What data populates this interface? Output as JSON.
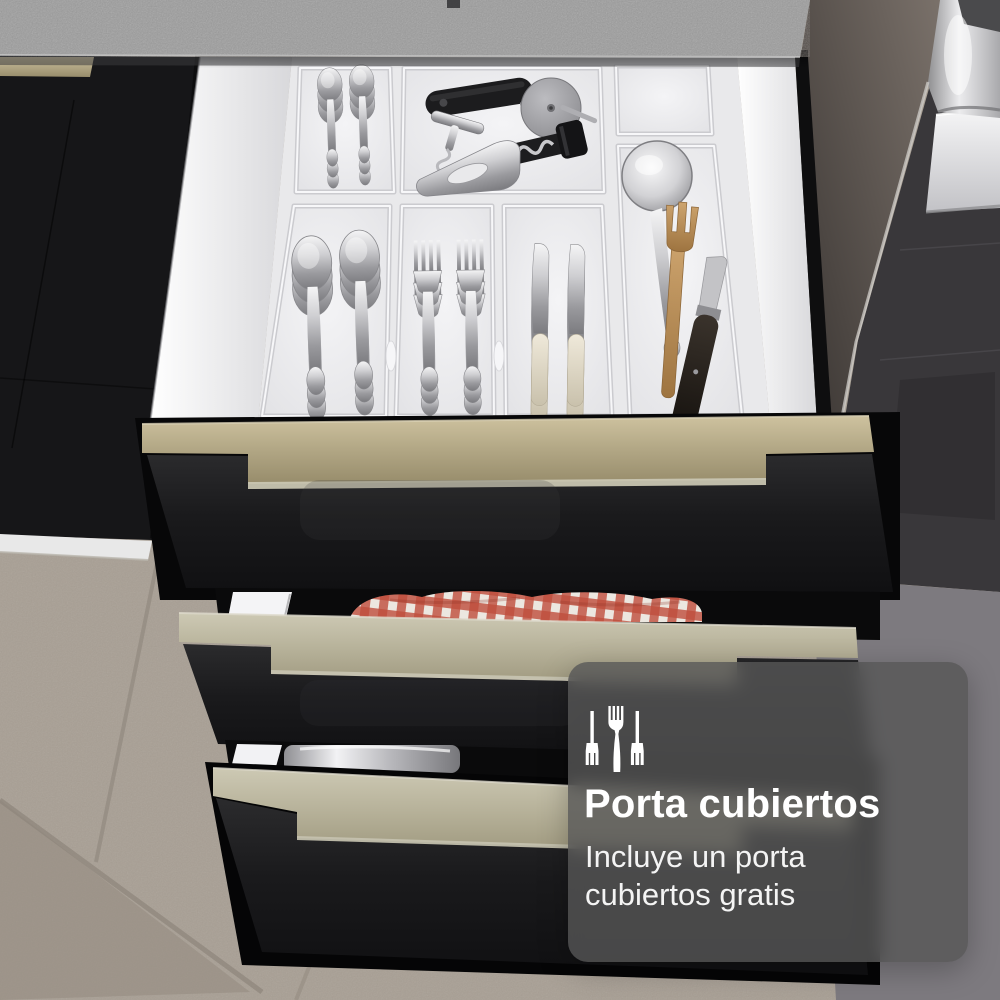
{
  "overlay": {
    "title": "Porta cubiertos",
    "subtitle": "Incluye un porta cubiertos gratis",
    "subtitle_lines": [
      "Incluye un porta",
      "cubiertos gratis"
    ],
    "icon": "cutlery-icon",
    "background": "rgba(86,86,86,0.8)",
    "text_color": "#ffffff"
  },
  "scene": {
    "description": "Open black kitchen drawer with white cutlery organizer tray, two more drawers below, gray concrete countertop, oven tower at right, tiled floor",
    "colors": {
      "countertop": "#9c9c9c",
      "cabinet_black": "#161618",
      "handle_champagne": "#b4a987",
      "handle_champagne_light": "#b7b29a",
      "tray_white": "#e9e9eb",
      "floor_tile": "#a89f94",
      "appliance_dark": "#39373a",
      "appliance_panel": "#7d7a7f",
      "stainless": "#d9d9db",
      "cloth_red": "#bf4d3c",
      "wood": "#c0945e"
    },
    "items": [
      "teaspoons",
      "serving-spoons",
      "forks",
      "knives",
      "pizza-cutter",
      "t-corkscrew",
      "wing-corkscrew",
      "bottle-opener",
      "ladle",
      "wooden-fork",
      "black-knife",
      "kitchen-cloth",
      "pot"
    ]
  }
}
